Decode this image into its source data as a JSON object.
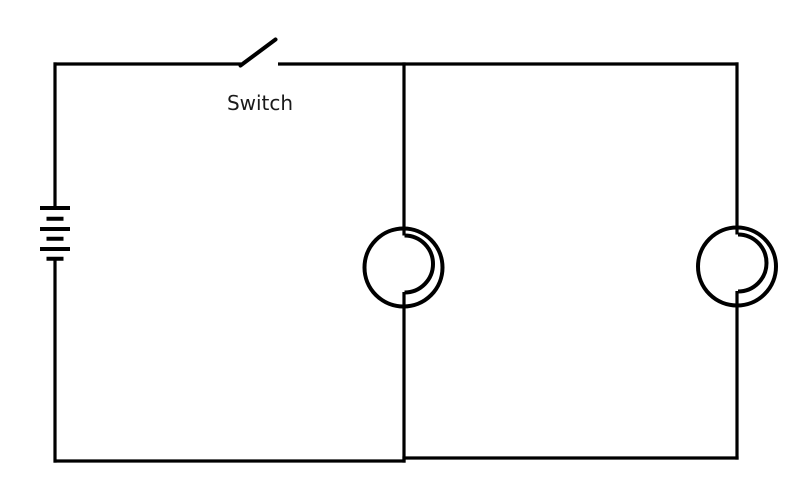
{
  "diagram": {
    "kind": "circuit-schematic",
    "colors": {
      "background": "#ffffff",
      "wire": "#000000",
      "label": "#1a1a1a"
    },
    "labels": {
      "switch": "Switch"
    },
    "components": [
      {
        "name": "battery",
        "symbol": "multi-cell-battery",
        "cells": 3,
        "state": "",
        "position": "left-branch"
      },
      {
        "name": "switch",
        "symbol": "knife-switch",
        "state": "open",
        "label": "Switch",
        "position": "top-wire"
      },
      {
        "name": "lamp-1",
        "symbol": "light-bulb",
        "state": "",
        "position": "middle-branch"
      },
      {
        "name": "lamp-2",
        "symbol": "light-bulb",
        "state": "",
        "position": "right-branch"
      }
    ],
    "topology": "battery and open switch in series with two lamps connected in parallel"
  }
}
